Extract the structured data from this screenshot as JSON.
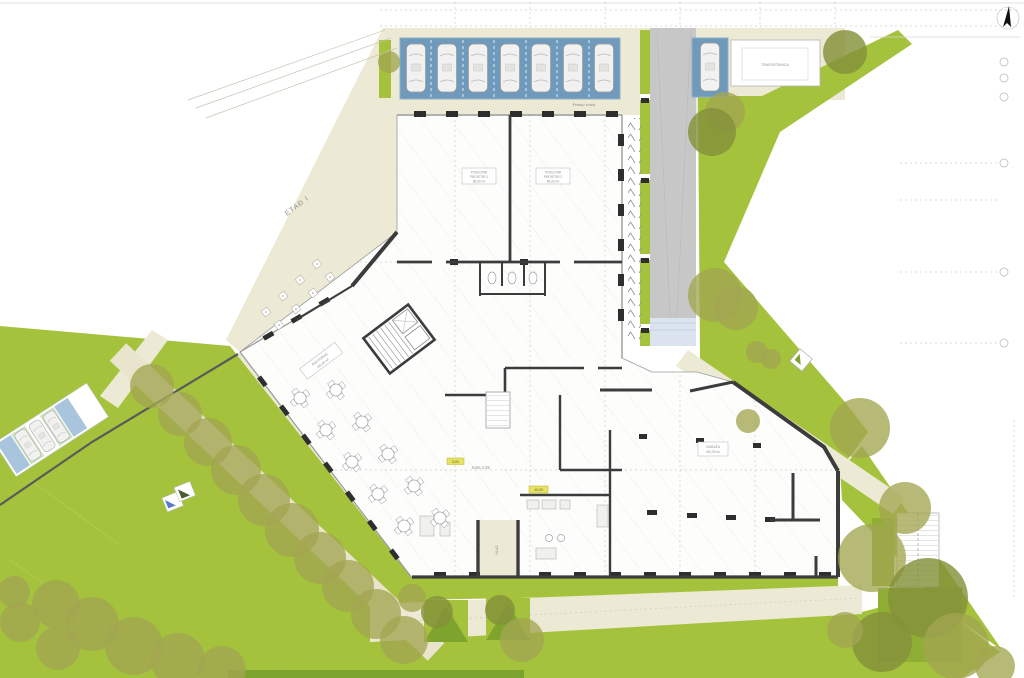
{
  "colors": {
    "lawn": "#a5c23d",
    "lawnDark": "#8fae33",
    "lawnStrip": "#7da32f",
    "treeOlive": "#a3a551",
    "treeDark": "#84913a",
    "path": "#ece9d4",
    "canopy": "#6f9abc",
    "stallBlue": "#a9c4dd",
    "stallGreen": "#cfe3c0",
    "road": "#c7c7c7",
    "ramp": "#dbe3ef",
    "wall": "#3c3c3c",
    "highlightTag": "#e6e263"
  },
  "labels": {
    "etaz": "ETAĐ I",
    "kota": "Kota 2,92",
    "shop1_l1": "POSLOVNI",
    "shop1_l2": "PROSTOR 1",
    "shop1_l3": "86,50 m²",
    "shop2_l1": "POSLOVNI",
    "shop2_l2": "PROSTOR 2",
    "shop2_l3": "84,20 m²",
    "restaurant_l1": "RESTORAN",
    "restaurant_l2": "165,00 m²",
    "garage_l1": "GARAŽA",
    "garage_l2": "420,00 m²",
    "entry": "ULAZ",
    "trafo": "TRAFOSTANICA",
    "access": "Pristup vozila",
    "level_a": "0,00",
    "level_b": "±0,00"
  }
}
